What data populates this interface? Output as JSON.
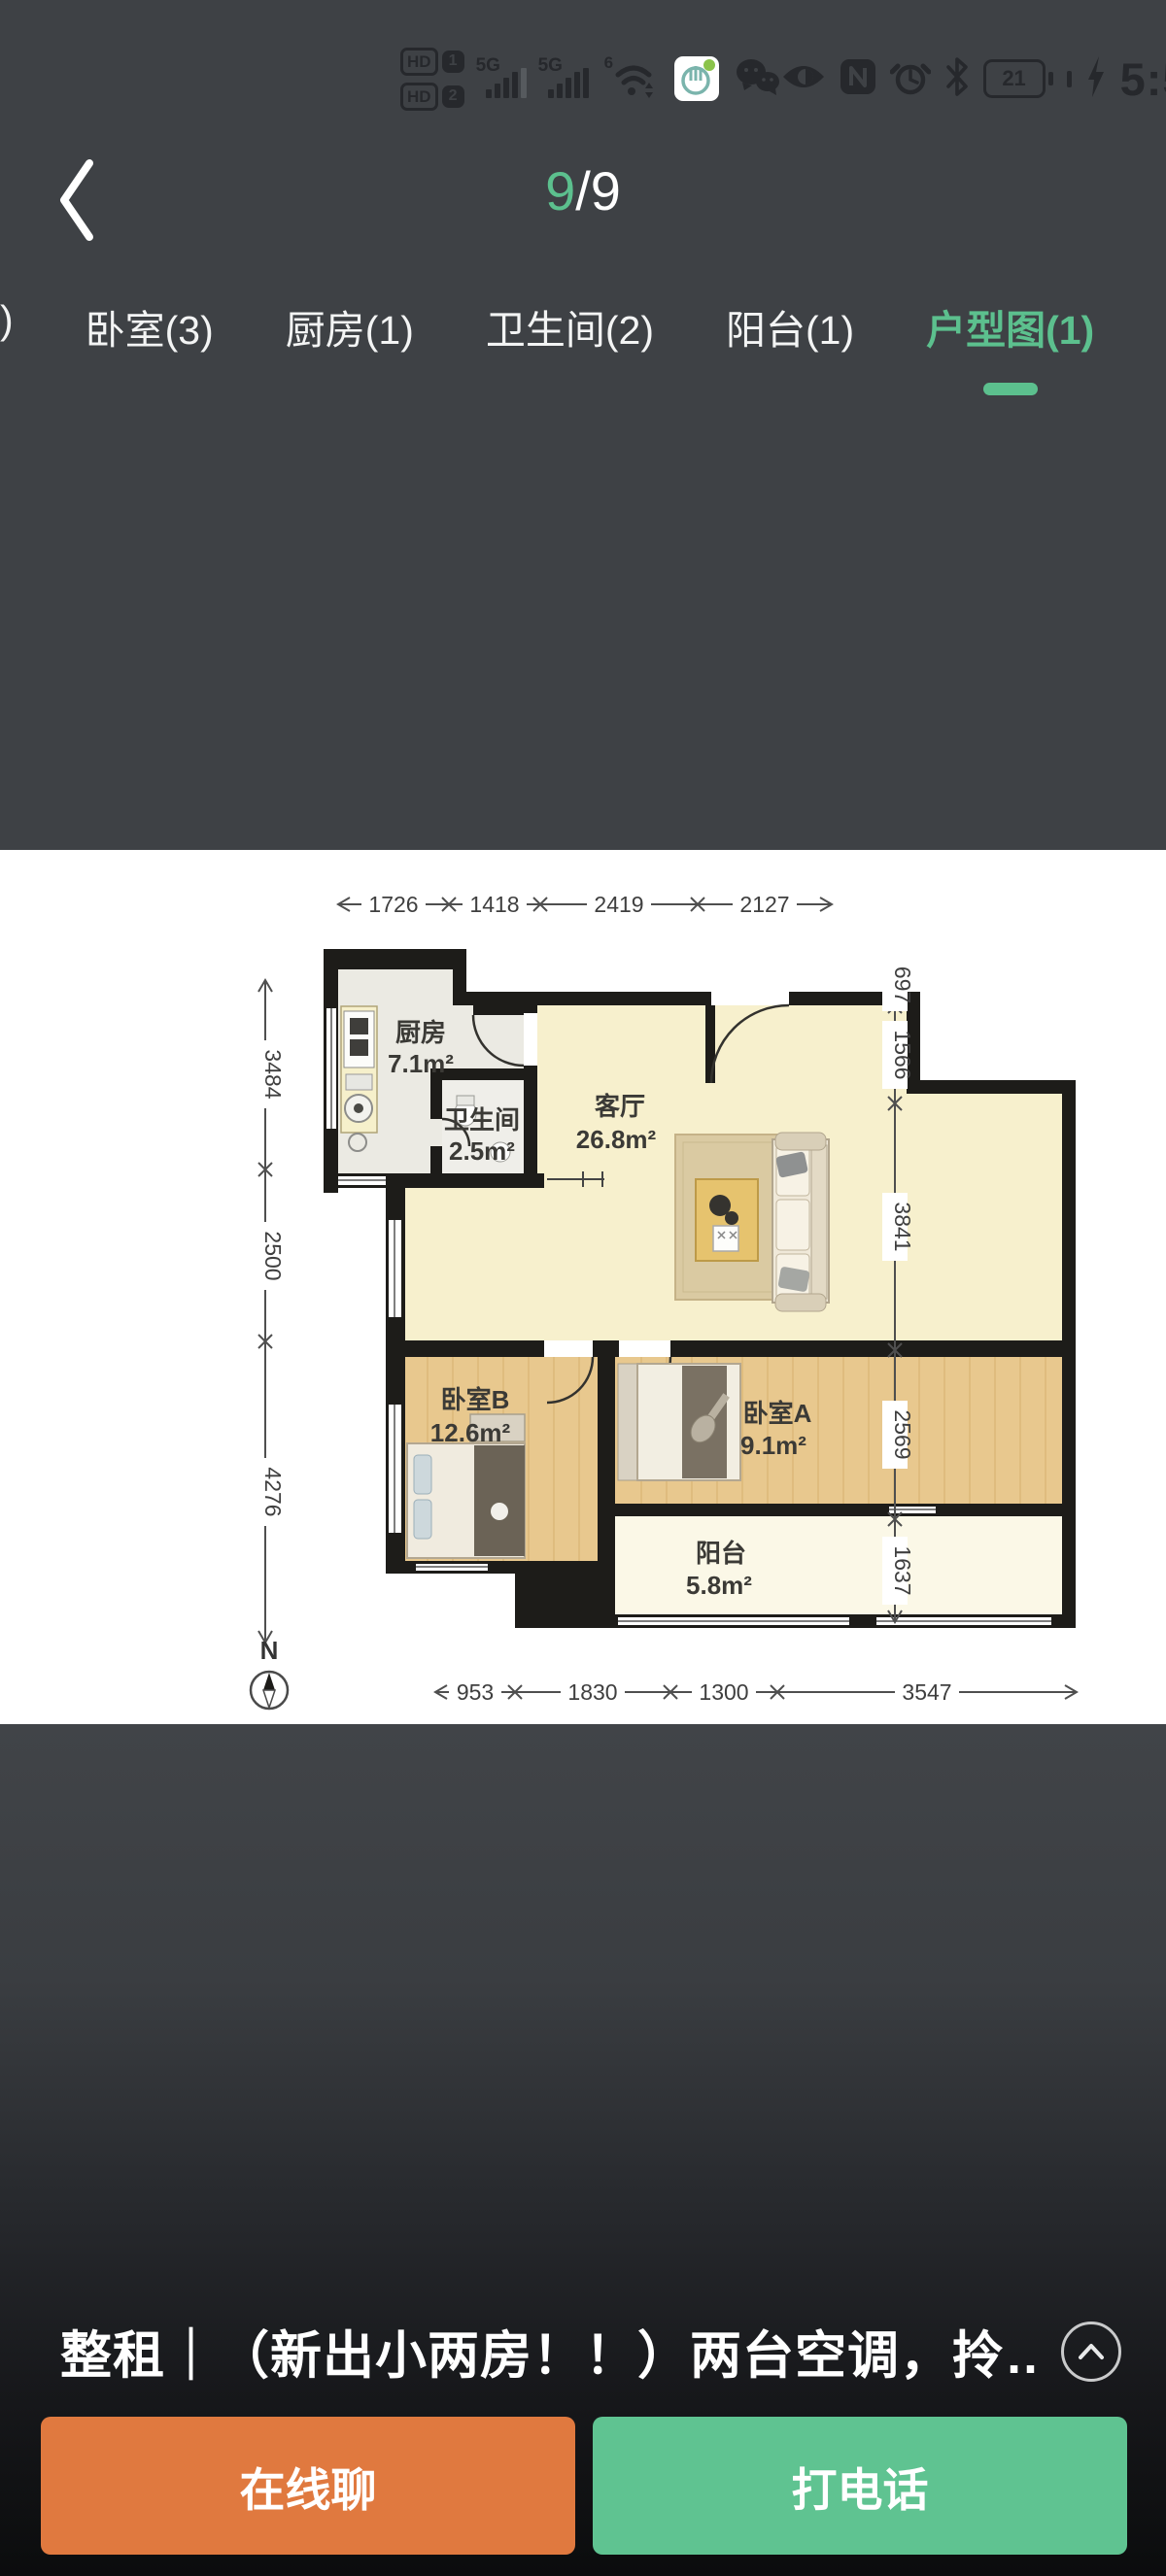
{
  "colors": {
    "app_background": "#3e4145",
    "accent_green": "#5cc08e",
    "button_orange": "#e0793f",
    "button_green": "#5fc391",
    "status_icon": "#26282c",
    "plan_background": "#ffffff"
  },
  "status_bar": {
    "hd": "HD",
    "hd1": "1",
    "hd2": "2",
    "net1": "5G",
    "net2": "5G",
    "wifi_gen": "6",
    "battery_level": "21",
    "time": "5:54"
  },
  "header": {
    "page_current": "9",
    "page_separator": "/",
    "page_total": "9"
  },
  "tabs": {
    "items": [
      ")",
      "卧室(3)",
      "厨房(1)",
      "卫生间(2)",
      "阳台(1)",
      "户型图(1)"
    ],
    "active_label": "户型图(1)"
  },
  "floorplan": {
    "rooms": {
      "kitchen": {
        "name": "厨房",
        "area": "7.1m²"
      },
      "bath": {
        "name": "卫生间",
        "area": "2.5m²"
      },
      "living": {
        "name": "客厅",
        "area": "26.8m²"
      },
      "bedroom_b": {
        "name": "卧室B",
        "area": "12.6m²"
      },
      "bedroom_a": {
        "name": "卧室A",
        "area": "9.1m²"
      },
      "balcony": {
        "name": "阳台",
        "area": "5.8m²"
      }
    },
    "dims": {
      "top": [
        "1726",
        "1418",
        "2419",
        "2127"
      ],
      "bottom": [
        "953",
        "1830",
        "1300",
        "3547"
      ],
      "left": [
        "3484",
        "2500",
        "4276"
      ],
      "right": [
        "697",
        "1566",
        "3841",
        "2569",
        "1637"
      ]
    },
    "compass": "N"
  },
  "listing": {
    "title": "整租｜（新出小两房！！）两台空调，拎…"
  },
  "actions": {
    "chat": "在线聊",
    "call": "打电话"
  }
}
